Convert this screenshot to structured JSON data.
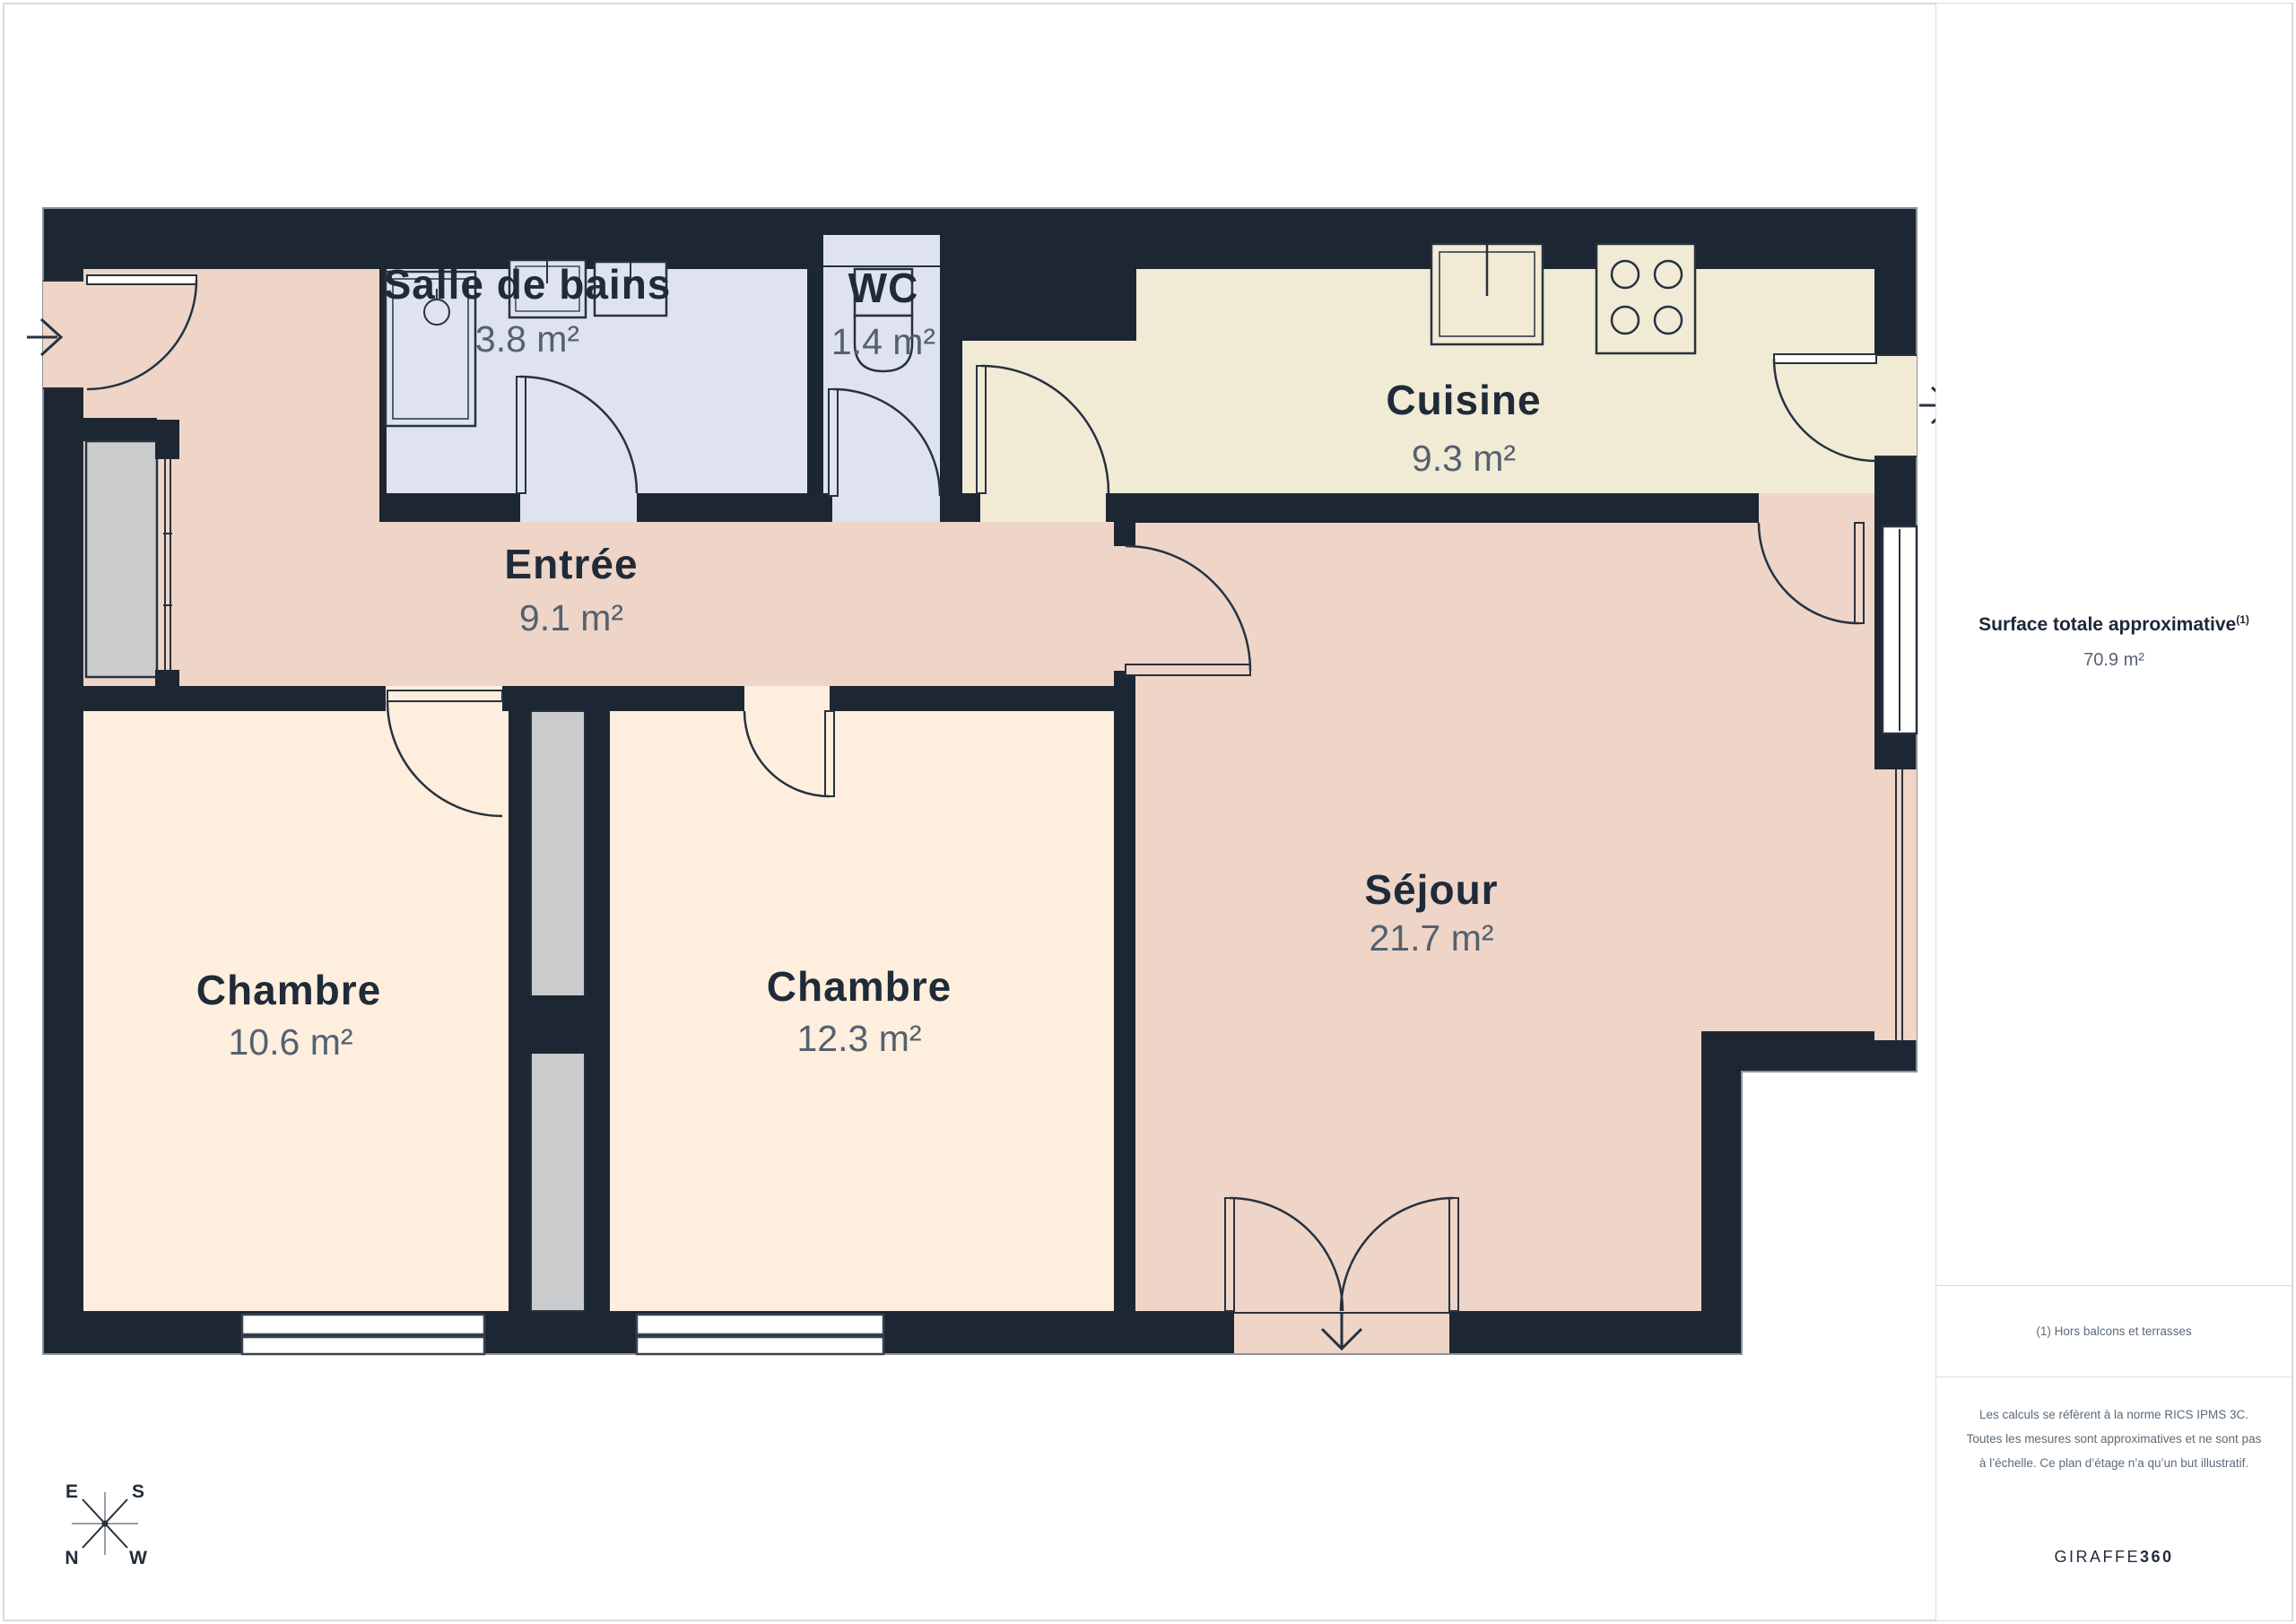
{
  "colors": {
    "wall": "#1d2733",
    "line": "#27313f",
    "floor_pink": "#eed5c7",
    "floor_cream": "#fdeedd",
    "floor_kitchen": "#f1ebd6",
    "floor_bath": "#dfe3ef",
    "shaft_gray": "#c9cbcc",
    "window_white": "#ffffff",
    "label": "#202b39",
    "area_text": "#54616f"
  },
  "plan": {
    "rooms": [
      {
        "name": "Salle de bains",
        "area": "3.8 m²"
      },
      {
        "name": "WC",
        "area": "1.4 m²"
      },
      {
        "name": "Cuisine",
        "area": "9.3 m²"
      },
      {
        "name": "Entrée",
        "area": "9.1 m²"
      },
      {
        "name": "Chambre",
        "area": "10.6 m²"
      },
      {
        "name": "Chambre",
        "area": "12.3 m²"
      },
      {
        "name": "Séjour",
        "area": "21.7 m²"
      }
    ],
    "compass": {
      "east": "E",
      "south": "S",
      "north": "N",
      "west": "W"
    }
  },
  "sidebar": {
    "surface_label": "Surface totale approximative",
    "surface_sup": "(1)",
    "surface_value": "70.9 m²",
    "footnote": "(1) Hors balcons et terrasses",
    "disclaimer": "Les calculs se réfèrent à la norme RICS IPMS 3C. Toutes les mesures sont approximatives et ne sont pas à l’échelle. Ce plan d’étage n’a qu’un but illustratif.",
    "brand_name": "GIRAFFE",
    "brand_suffix": "360"
  }
}
